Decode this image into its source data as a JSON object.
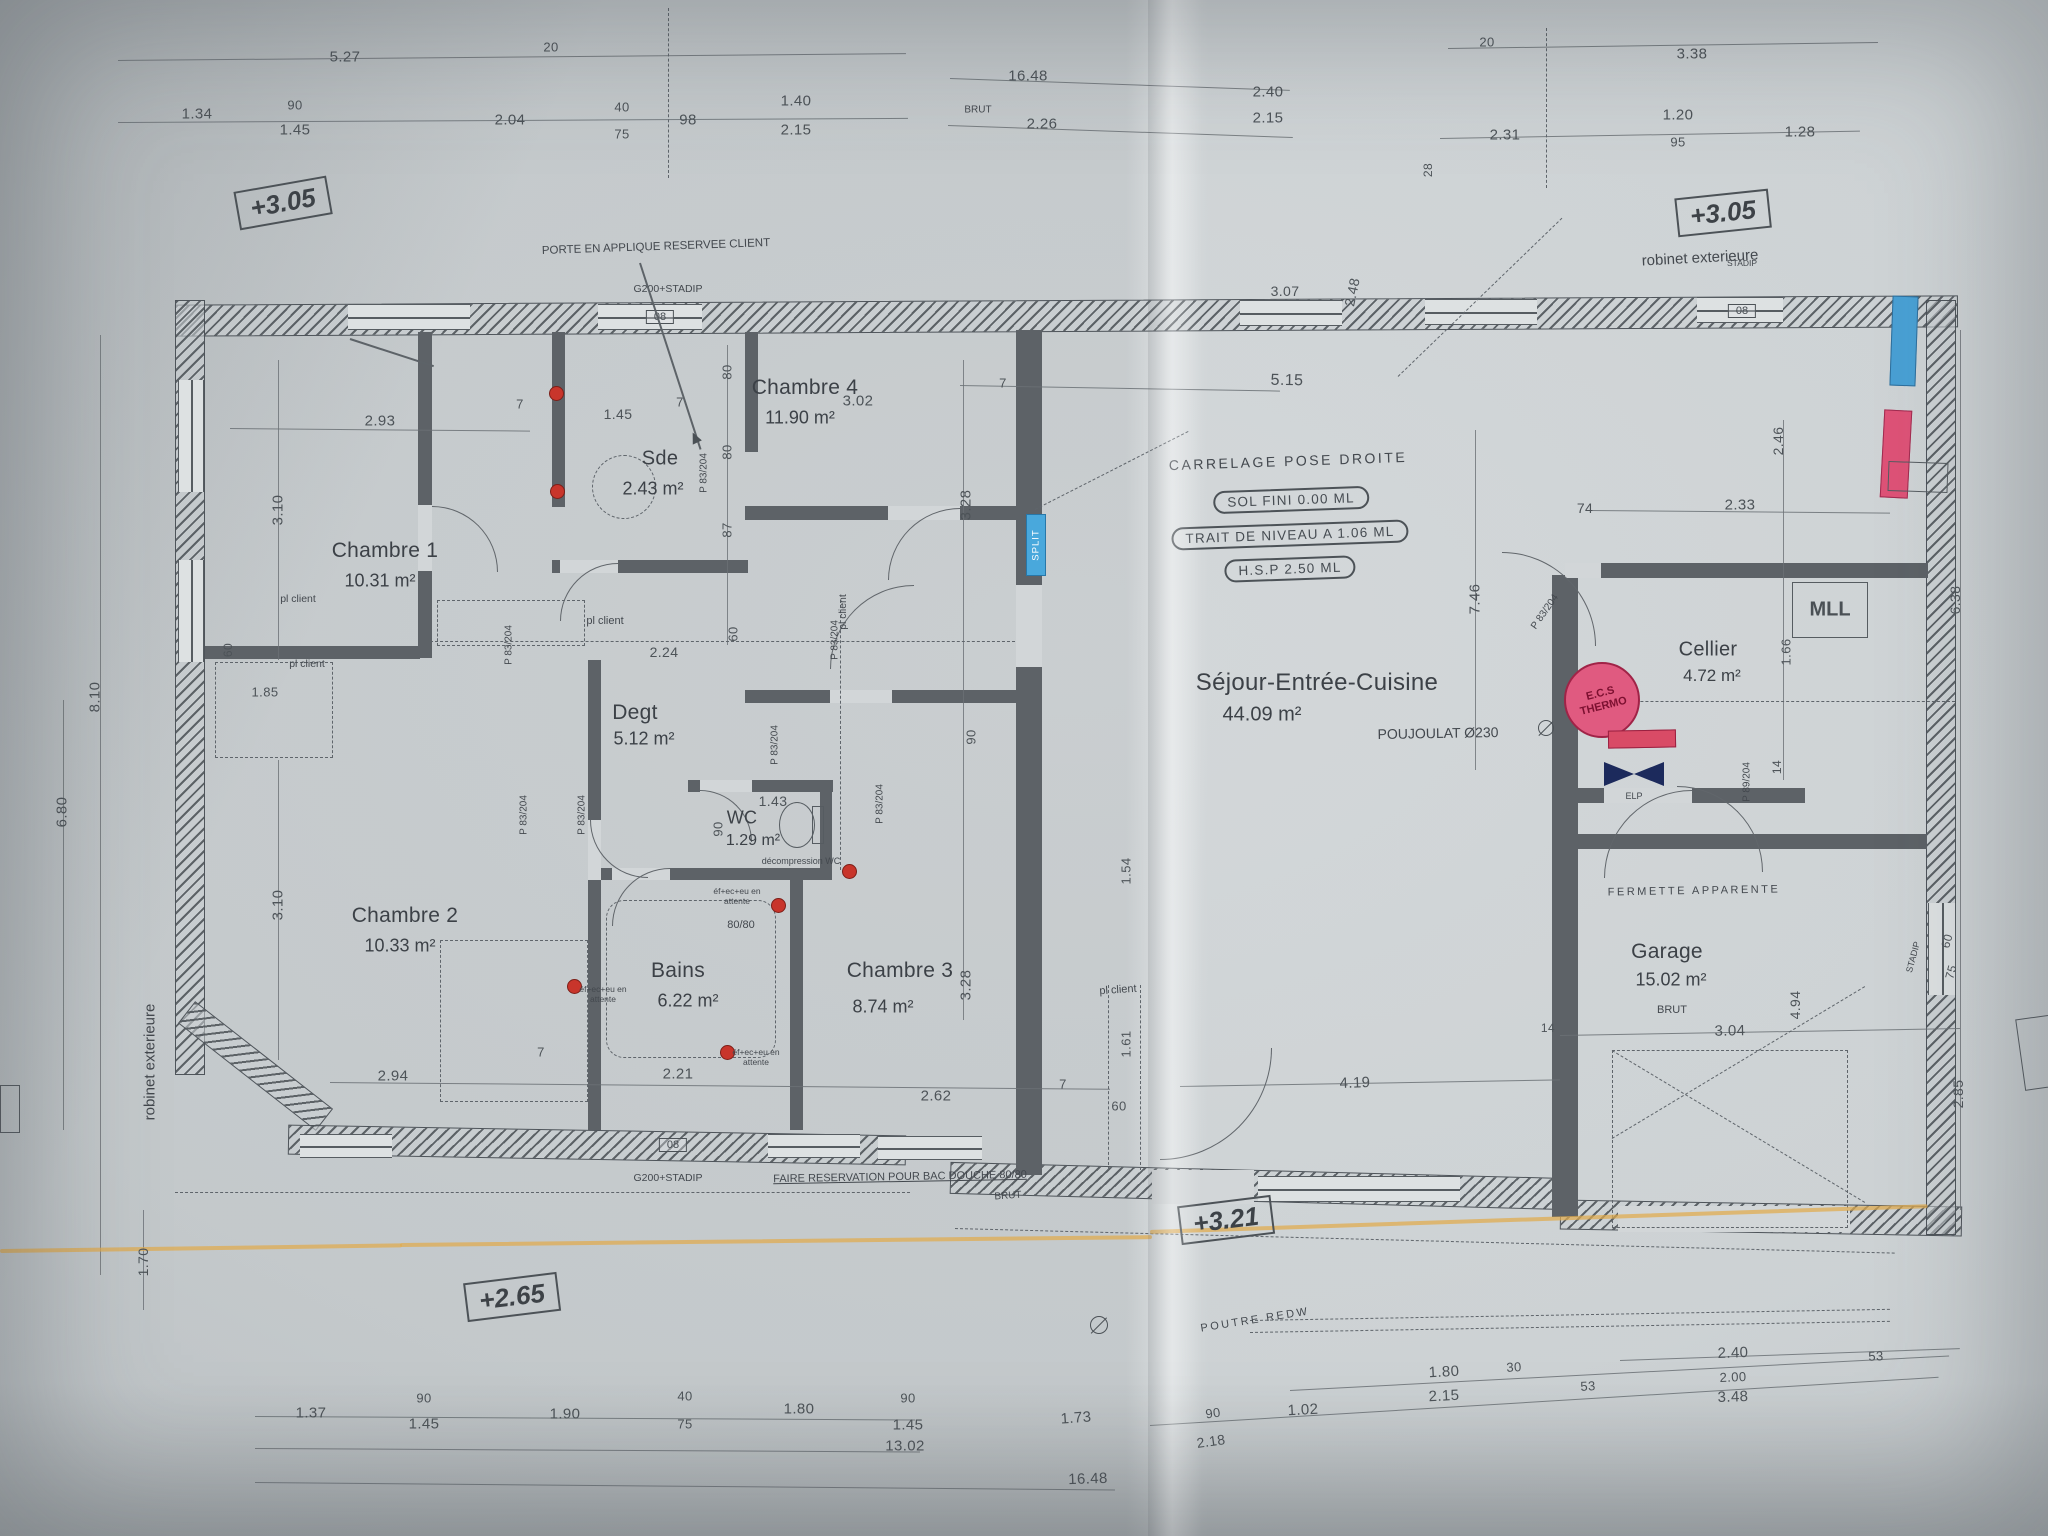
{
  "document_kind": "house floor plan (photographed blueprint)",
  "colors": {
    "paper": "#d2d6d8",
    "ink": "#4a5055",
    "wall": "#5d6267",
    "split_tag_blue": "#49a8dc",
    "ecs_red": "#e05a80",
    "window_tag_blue": "#49a0d4",
    "window_tag_pink": "#de5277",
    "plumbing_dot_red": "#c8352b",
    "highlighter_yellow": "#e0aa4c"
  },
  "rooms": [
    {
      "name": "Chambre 1",
      "area": "10.31 m²"
    },
    {
      "name": "Sde",
      "area": "2.43 m²"
    },
    {
      "name": "Chambre 4",
      "area": "11.90 m²"
    },
    {
      "name": "Degt",
      "area": "5.12 m²"
    },
    {
      "name": "WC",
      "area": "1.29 m²"
    },
    {
      "name": "Chambre 2",
      "area": "10.33 m²"
    },
    {
      "name": "Bains",
      "area": "6.22 m²"
    },
    {
      "name": "Chambre 3",
      "area": "8.74 m²"
    },
    {
      "name": "Séjour-Entrée-Cuisine",
      "area": "44.09 m²"
    },
    {
      "name": "Cellier",
      "area": "4.72 m²"
    },
    {
      "name": "Garage",
      "area": "15.02 m²"
    }
  ],
  "elevation_markers": [
    "+3.05",
    "+3.05",
    "+2.65",
    "+3.21"
  ],
  "fixtures": {
    "split": "SPLIT",
    "ecs": "E.C.S THERMO",
    "elp": "ELP",
    "mll": "MLL"
  },
  "annotations": {
    "porte": "PORTE EN APPLIQUE RESERVEE CLIENT",
    "carrelage": "CARRELAGE POSE DROITE",
    "sol_fini": "SOL FINI 0.00 ML",
    "trait": "TRAIT DE NIVEAU A 1.06 ML",
    "hsp": "H.S.P 2.50 ML",
    "poujoulat": "POUJOULAT Ø230",
    "fermette": "FERMETTE APPARENTE",
    "faire": "FAIRE RESERVATION POUR BAC DOUCHE 80/80",
    "decompression": "décompression WC",
    "attente": "éf+ec+eu en attente",
    "bac8080": "80/80",
    "pl_client": "pl client",
    "brut": "BRUT",
    "poutre": "POUTRE REDW",
    "robinet": "robinet exterieure",
    "stadip": "STADIP",
    "g200": "G200+STADIP",
    "n08": "08",
    "door_label": "P 83/204",
    "door_label_garage": "P 89/204"
  },
  "dimensions": [
    "5.27",
    "20",
    "16.48",
    "2.26",
    "2.40",
    "2.15",
    "2.31",
    "20",
    "3.38",
    "1.20",
    "95",
    "1.28",
    "1.34",
    "90",
    "1.45",
    "2.04",
    "40",
    "75",
    "98",
    "1.40",
    "2.15",
    "28",
    "3.10",
    "3.10",
    "8.10",
    "6.80",
    "1.70",
    "60",
    "1.85",
    "2.93",
    "7",
    "1.45",
    "7",
    "3.02",
    "7",
    "80",
    "80",
    "87",
    "60",
    "2.24",
    "3.28",
    "90",
    "3.28",
    "1.43",
    "90",
    "2.21",
    "2.62",
    "7",
    "60",
    "1.61",
    "1.54",
    "2.94",
    "7",
    "5.15",
    "3.07",
    "2.48",
    "7.46",
    "74",
    "2.33",
    "2.46",
    "1.66",
    "14",
    "6.38",
    "4.19",
    "14",
    "3.04",
    "4.94",
    "2.85",
    "60",
    "75",
    "1.37",
    "90",
    "1.45",
    "1.90",
    "40",
    "75",
    "1.80",
    "90",
    "1.45",
    "1.73",
    "90",
    "2.18",
    "1.02",
    "1.80",
    "2.15",
    "30",
    "53",
    "2.40",
    "2.00",
    "3.48",
    "53",
    "13.02",
    "16.48"
  ]
}
